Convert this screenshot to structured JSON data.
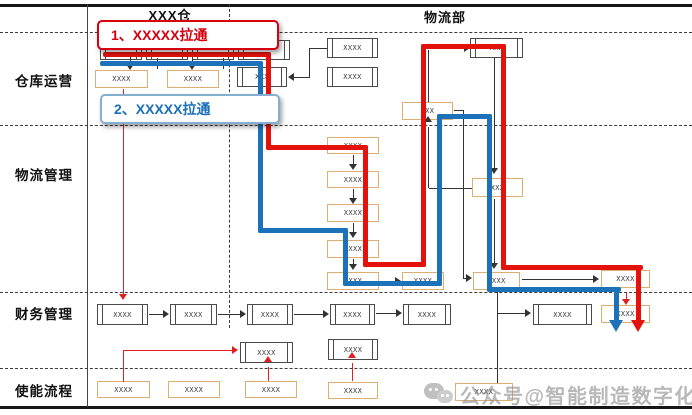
{
  "diagram": {
    "org_columns": [
      "XXX仓",
      "物流部"
    ],
    "lanes": [
      "仓库运营",
      "物流管理",
      "财务管理",
      "使能流程"
    ],
    "callouts": [
      {
        "label": "1、XXXXX拉通",
        "color": "#d7000f"
      },
      {
        "label": "2、XXXXX拉通",
        "color": "#1a6fba"
      }
    ],
    "node_label": "XXXX",
    "node_label_short": "XXX",
    "flow_colors": {
      "flow1_red": "#e3120b",
      "flow2_blue": "#1b72b8"
    },
    "accent_box_border": "#dcae72",
    "watermark": {
      "icon": "wechat-icon",
      "text": "公众号@智能制造数字化"
    }
  }
}
